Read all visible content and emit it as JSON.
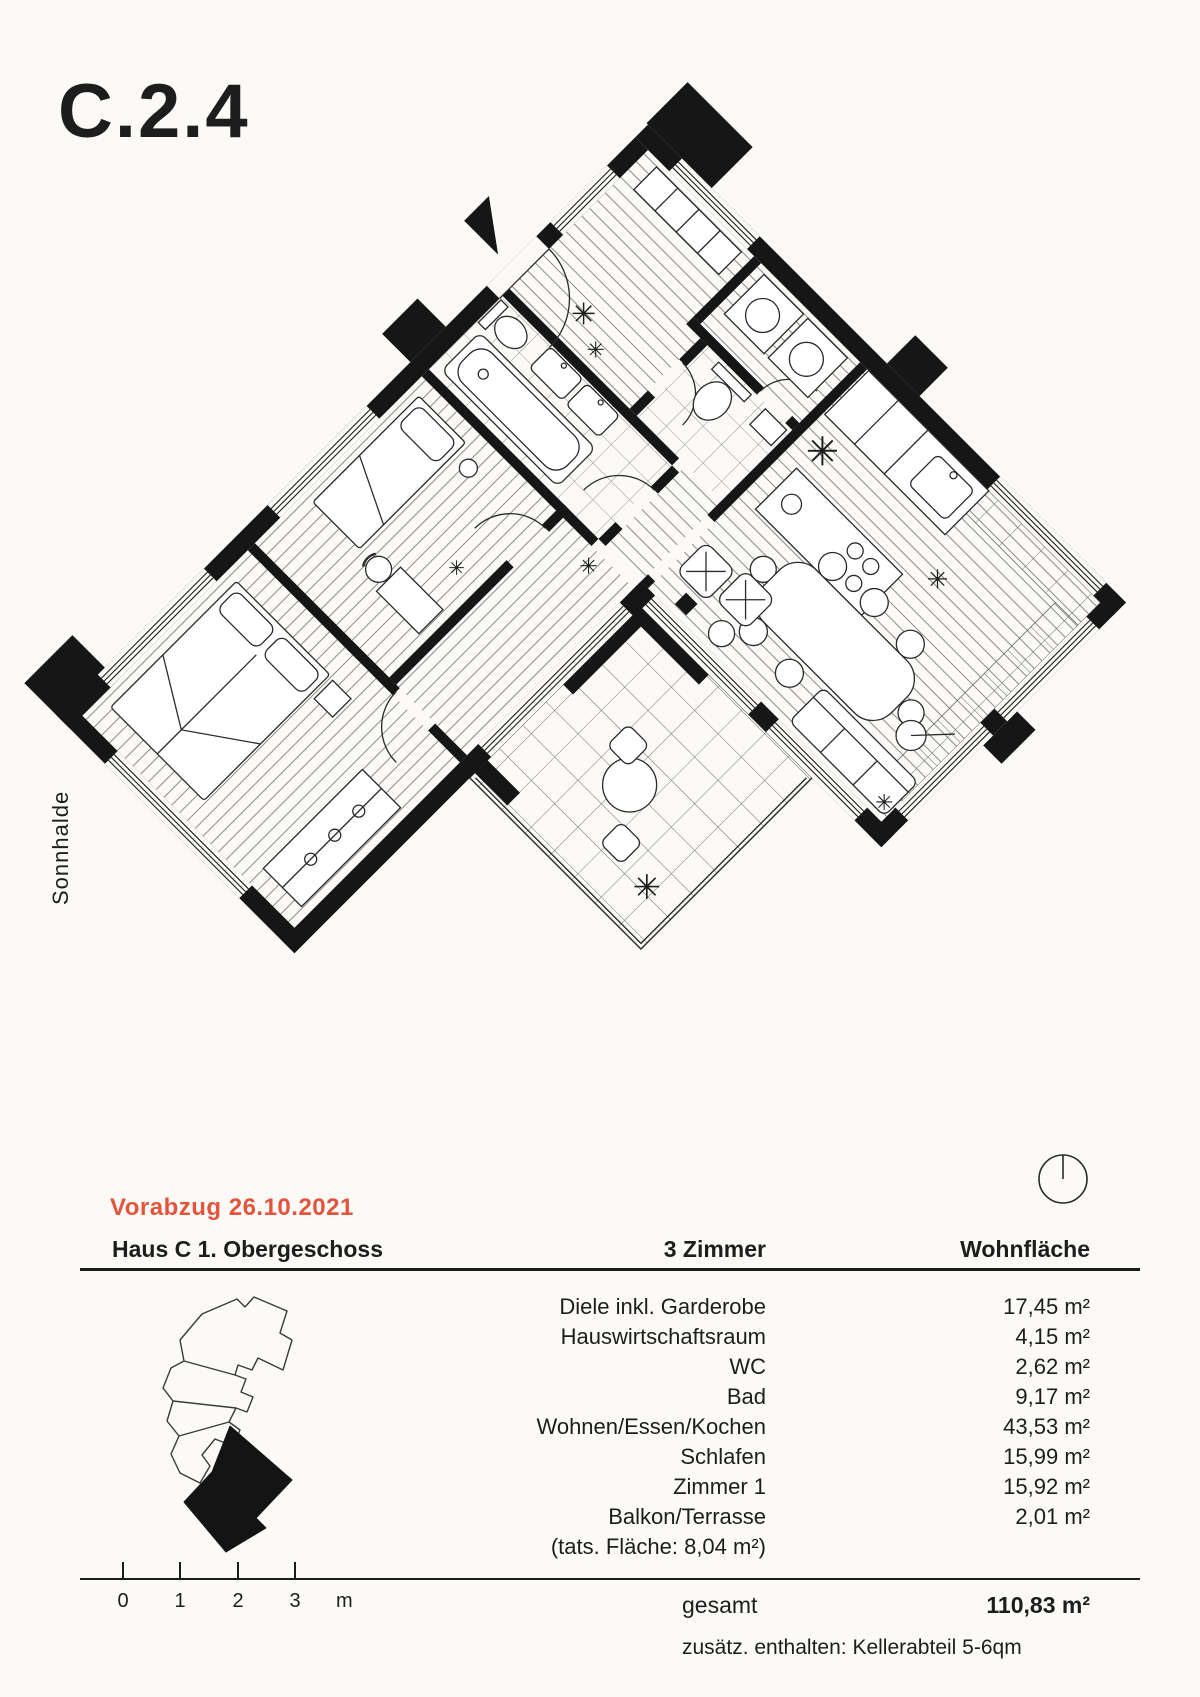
{
  "page": {
    "unit_code": "C.2.4",
    "street_label": "Sonnhalde"
  },
  "preliminary": {
    "label": "Vorabzug 26.10.2021",
    "color": "#e2553c"
  },
  "summary": {
    "house_header": "Haus C  1. Obergeschoss",
    "rooms_header": "3 Zimmer",
    "area_header": "Wohnfläche",
    "rows": [
      {
        "label": "Diele inkl. Garderobe",
        "value": "17,45 m²"
      },
      {
        "label": "Hauswirtschaftsraum",
        "value": "4,15 m²"
      },
      {
        "label": "WC",
        "value": "2,62 m²"
      },
      {
        "label": "Bad",
        "value": "9,17 m²"
      },
      {
        "label": "Wohnen/Essen/Kochen",
        "value": "43,53 m²"
      },
      {
        "label": "Schlafen",
        "value": "15,99 m²"
      },
      {
        "label": "Zimmer 1",
        "value": "15,92 m²"
      },
      {
        "label": "Balkon/Terrasse",
        "value": "2,01 m²"
      }
    ],
    "note": "(tats. Fläche: 8,04 m²)",
    "total_label": "gesamt",
    "total_value": "110,83 m²",
    "additional": "zusätz. enthalten:  Kellerabteil 5-6qm"
  },
  "scalebar": {
    "labels": [
      "0",
      "1",
      "2",
      "3"
    ],
    "unit": "m"
  },
  "icons": {
    "plant_glyph": "✳",
    "north_indicator": "circle-with-meridian-line",
    "entrance_marker": "black-triangle"
  },
  "colors": {
    "accent": "#e2553c",
    "ink": "#1d1d1d",
    "walls": "#161616",
    "paper": "#fbfaf7"
  }
}
